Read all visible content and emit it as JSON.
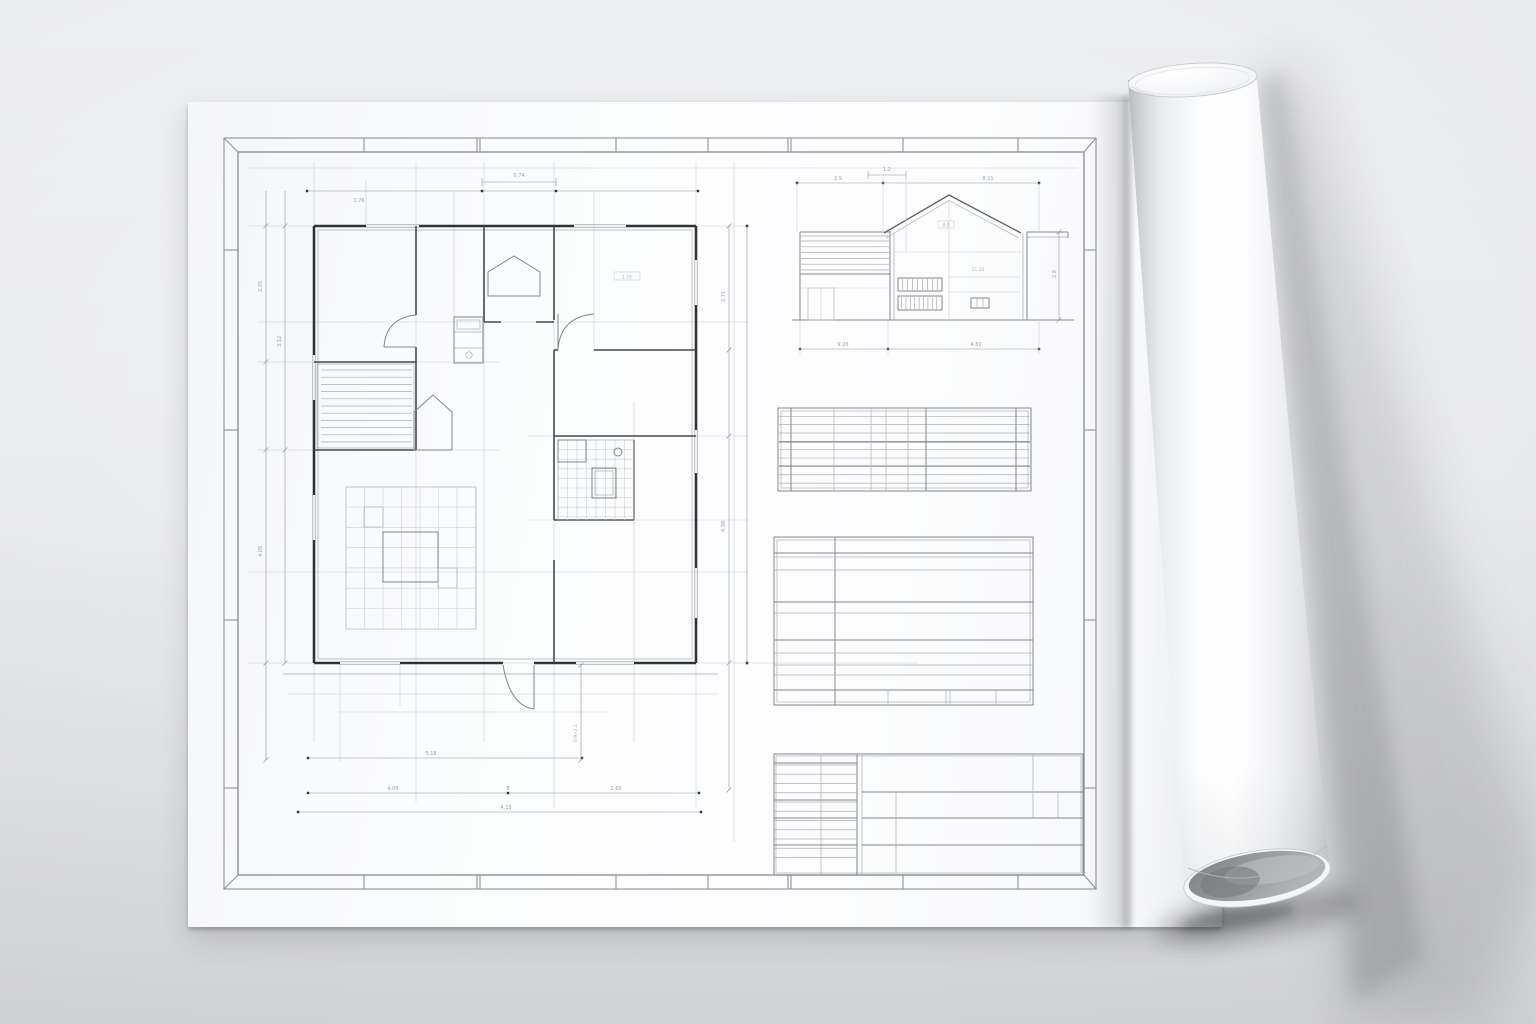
{
  "scene": {
    "description": "architectural blueprint sheet mockup with rolled right edge",
    "colors": {
      "wall": "#2f3236",
      "partition": "#45484d",
      "med": "#83878c",
      "thin": "#aab0b5",
      "faint": "#ccd0d5",
      "dim": "#8f959b",
      "dimtext": "#8a9096",
      "frame": "#8f9296",
      "bg-top": "#ecedef",
      "bg-bottom": "#d6d7da",
      "sheet": "#fbfcfd",
      "roll-highlight": "#ffffff",
      "roll-shade": "#c4c6c9",
      "roll-interior": "#8a8c90"
    }
  },
  "labels": {
    "plan_top_small": "0.74",
    "plan_top_long": "1.76",
    "plan_left_a1": "2.35",
    "plan_left_a2": "4.05",
    "plan_left_b": "3.12",
    "plan_right_1": "2.71",
    "plan_right_2": "4.38",
    "plan_bottom_1": "5.18",
    "plan_bottom_2a": "4.05",
    "plan_bottom_2b": "8",
    "plan_bottom_2c": "2.60",
    "plan_bottom_3": "4.15",
    "plan_door_v": "0.9×2.1",
    "room_bedroom": "1 25",
    "elev_top_small": "1.2",
    "elev_top_left": "2.9",
    "elev_top_long": "8.11",
    "elev_gable": "8.0",
    "elev_mid": "51 25",
    "elev_right_v": "2.8",
    "elev_bottom_1": "9.26",
    "elev_bottom_2": "4.81"
  }
}
